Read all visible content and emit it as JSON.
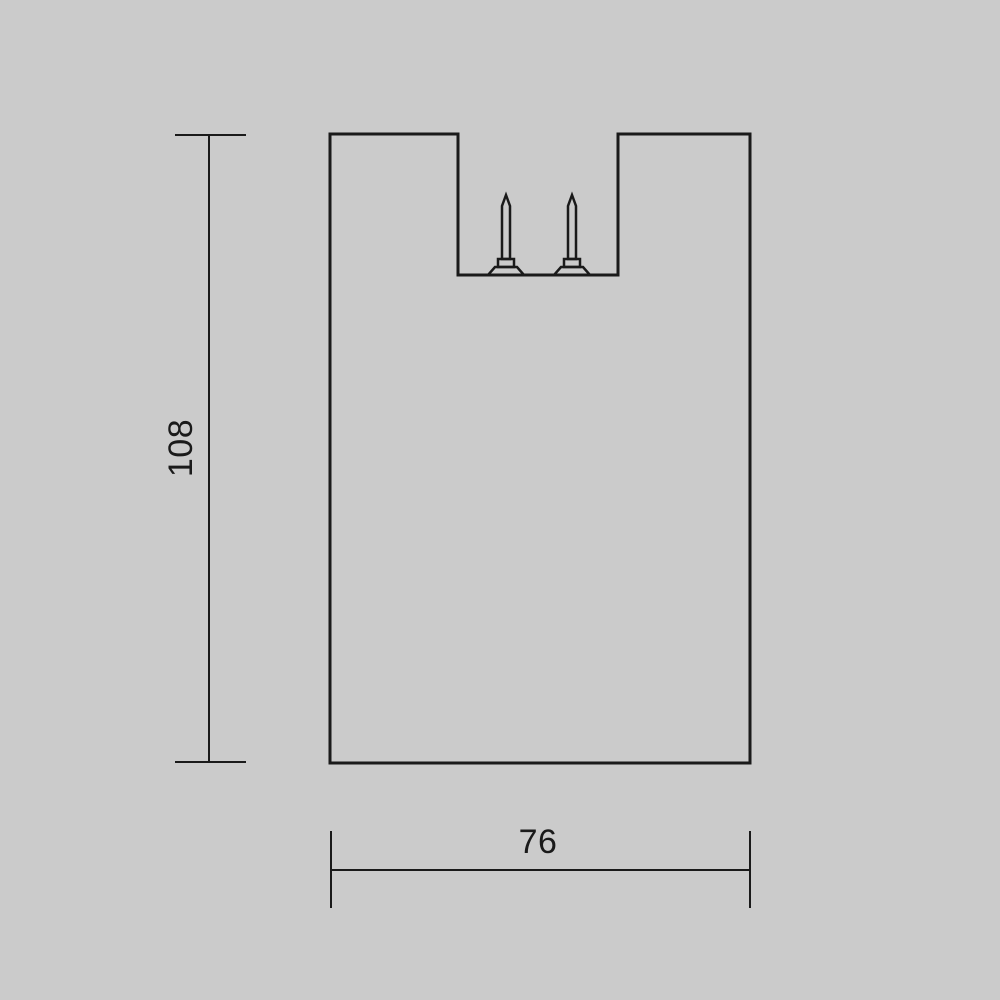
{
  "colors": {
    "background": "#cbcbcb",
    "line": "#1a1a1a"
  },
  "dimensions": {
    "height": {
      "label": "108"
    },
    "width": {
      "label": "76"
    }
  }
}
